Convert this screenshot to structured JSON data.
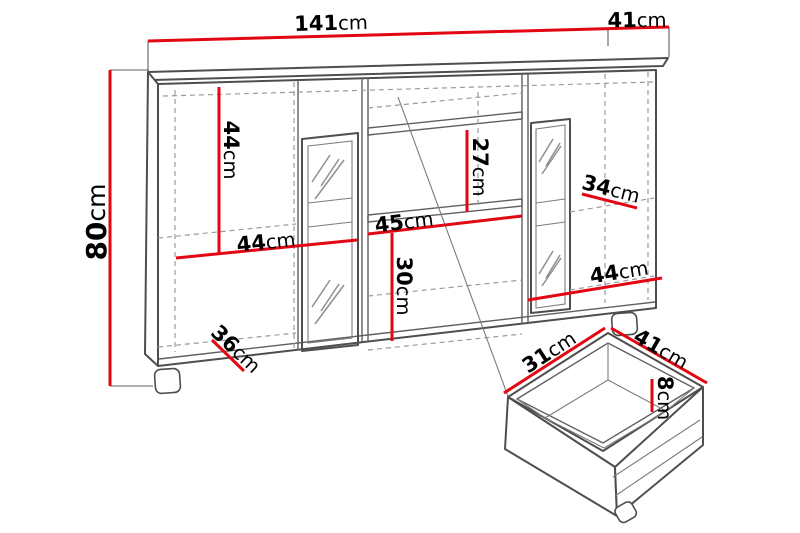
{
  "diagram": {
    "description": "Sideboard cabinet dimension drawing with detached drawer detail",
    "colors": {
      "dimension_red": "#e30613",
      "outline_gray": "#4e4e4e",
      "hidden_line_gray": "#9b9b9b",
      "label_black": "#000000",
      "background": "#ffffff"
    },
    "dims": {
      "total_width": {
        "value": "141",
        "unit": "cm"
      },
      "total_depth": {
        "value": "41",
        "unit": "cm"
      },
      "total_height": {
        "value": "80",
        "unit": "cm"
      },
      "left_compartment_height": {
        "value": "44",
        "unit": "cm"
      },
      "left_compartment_width": {
        "value": "44",
        "unit": "cm"
      },
      "niche_height": {
        "value": "27",
        "unit": "cm"
      },
      "niche_width": {
        "value": "45",
        "unit": "cm"
      },
      "lower_compartment_height": {
        "value": "30",
        "unit": "cm"
      },
      "right_shelf_depth": {
        "value": "34",
        "unit": "cm"
      },
      "right_compartment_width": {
        "value": "44",
        "unit": "cm"
      },
      "base_depth": {
        "value": "36",
        "unit": "cm"
      },
      "drawer_depth": {
        "value": "31",
        "unit": "cm"
      },
      "drawer_width": {
        "value": "41",
        "unit": "cm"
      },
      "drawer_height": {
        "value": "8",
        "unit": "cm"
      }
    }
  }
}
